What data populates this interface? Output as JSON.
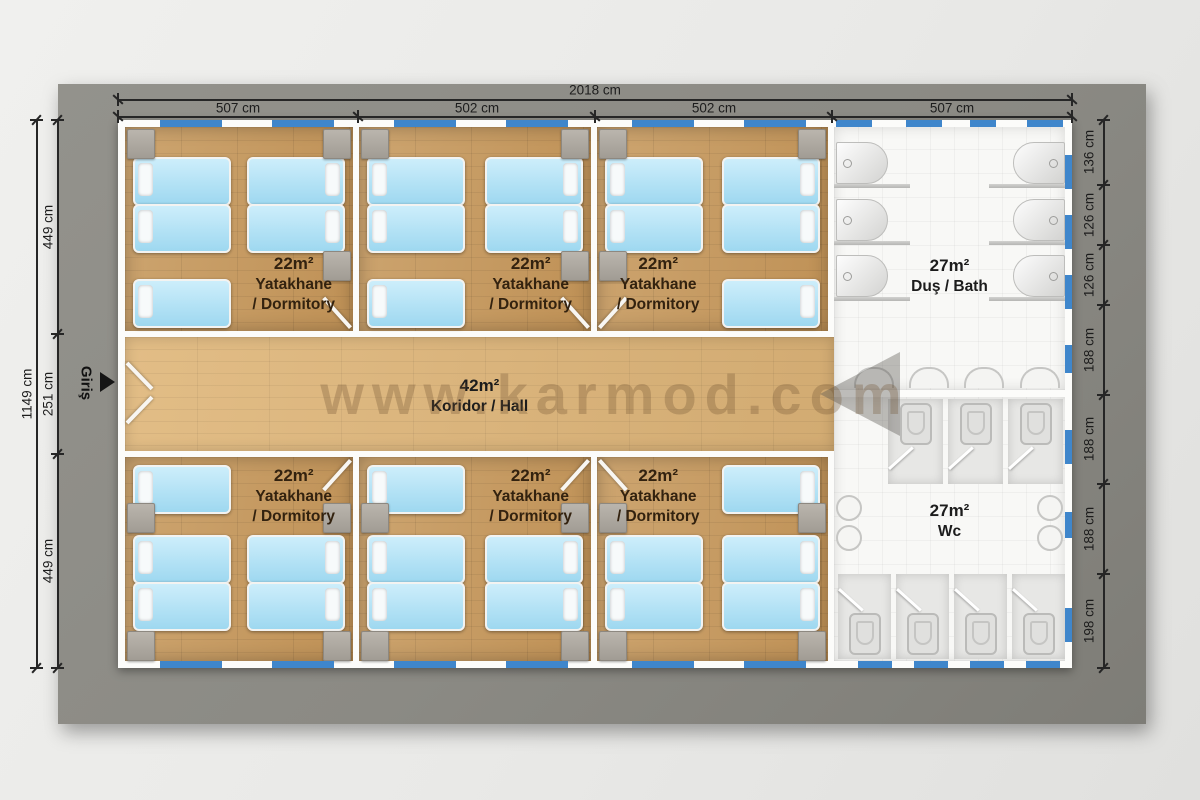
{
  "watermark": "www.karmod.com",
  "entrance": {
    "label": "Giriş"
  },
  "dimensions": {
    "overall_width": "2018 cm",
    "overall_height": "1149 cm",
    "top_segments": [
      "507 cm",
      "502 cm",
      "502 cm",
      "507 cm"
    ],
    "left_segments": [
      "449 cm",
      "251 cm",
      "449 cm"
    ],
    "right_segments": [
      "136 cm",
      "126 cm",
      "126 cm",
      "188 cm",
      "188 cm",
      "188 cm",
      "198 cm"
    ]
  },
  "rooms": {
    "dormitory": {
      "area": "22m²",
      "name_tr": "Yatakhane",
      "name_en": "/ Dormitory"
    },
    "corridor": {
      "area": "42m²",
      "name": "Koridor / Hall"
    },
    "bath": {
      "area": "27m²",
      "name": "Duş / Bath"
    },
    "wc": {
      "area": "27m²",
      "name": "Wc"
    }
  },
  "colors": {
    "window_blue": "#3f86cb",
    "wood_floor": "#c59a63",
    "corridor_floor": "#d9b37c",
    "board_grey": "#8b8a84",
    "bed_blue": "#aee0f5"
  }
}
